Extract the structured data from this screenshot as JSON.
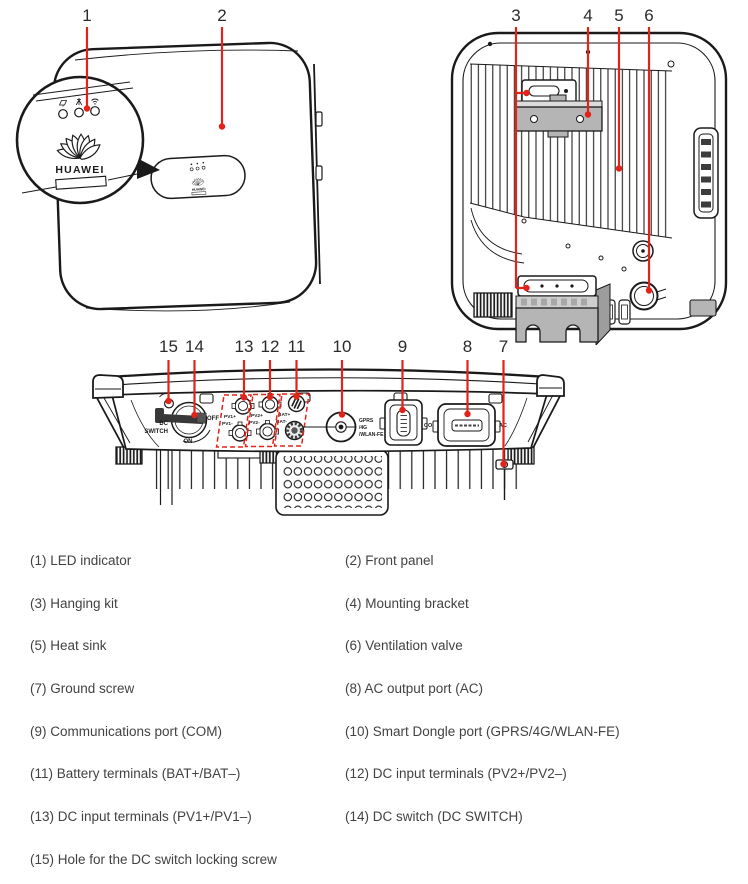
{
  "colors": {
    "callout_red": "#e2231a",
    "ink": "#1a1a1a",
    "number_text": "#2b2b2b",
    "legend_text": "#424242",
    "bracket_gray": "#b5b5b5"
  },
  "brand": "HUAWEI",
  "callouts": {
    "front": [
      "1",
      "2"
    ],
    "back": [
      "3",
      "4",
      "5",
      "6"
    ],
    "bottom": [
      "15",
      "14",
      "13",
      "12",
      "11",
      "10",
      "9",
      "8",
      "7"
    ]
  },
  "device_labels": {
    "dc": "DC",
    "switch": "SWITCH",
    "off": "OFF",
    "on": "ON",
    "pv1_plus": "PV1+",
    "pv1_minus": "PV1-",
    "pv2_plus": "PV2+",
    "pv2_minus": "PV2-",
    "bat_plus": "BAT+",
    "bat_minus": "BAT-",
    "dongle_1": "GPRS",
    "dongle_2": "/4G",
    "dongle_3": "/WLAN-FE",
    "com": "COM",
    "ac": "AC"
  },
  "legend": {
    "items": [
      "(1) LED indicator",
      "(2) Front panel",
      "(3) Hanging kit",
      "(4) Mounting bracket",
      "(5) Heat sink",
      "(6) Ventilation valve",
      "(7) Ground screw",
      "(8) AC output port (AC)",
      "(9) Communications port (COM)",
      "(10) Smart Dongle port (GPRS/4G/WLAN-FE)",
      "(11) Battery terminals (BAT+/BAT–)",
      "(12) DC input terminals (PV2+/PV2–)",
      "(13) DC input terminals (PV1+/PV1–)",
      "(14) DC switch (DC SWITCH)",
      "(15) Hole for the DC switch locking screw"
    ]
  }
}
